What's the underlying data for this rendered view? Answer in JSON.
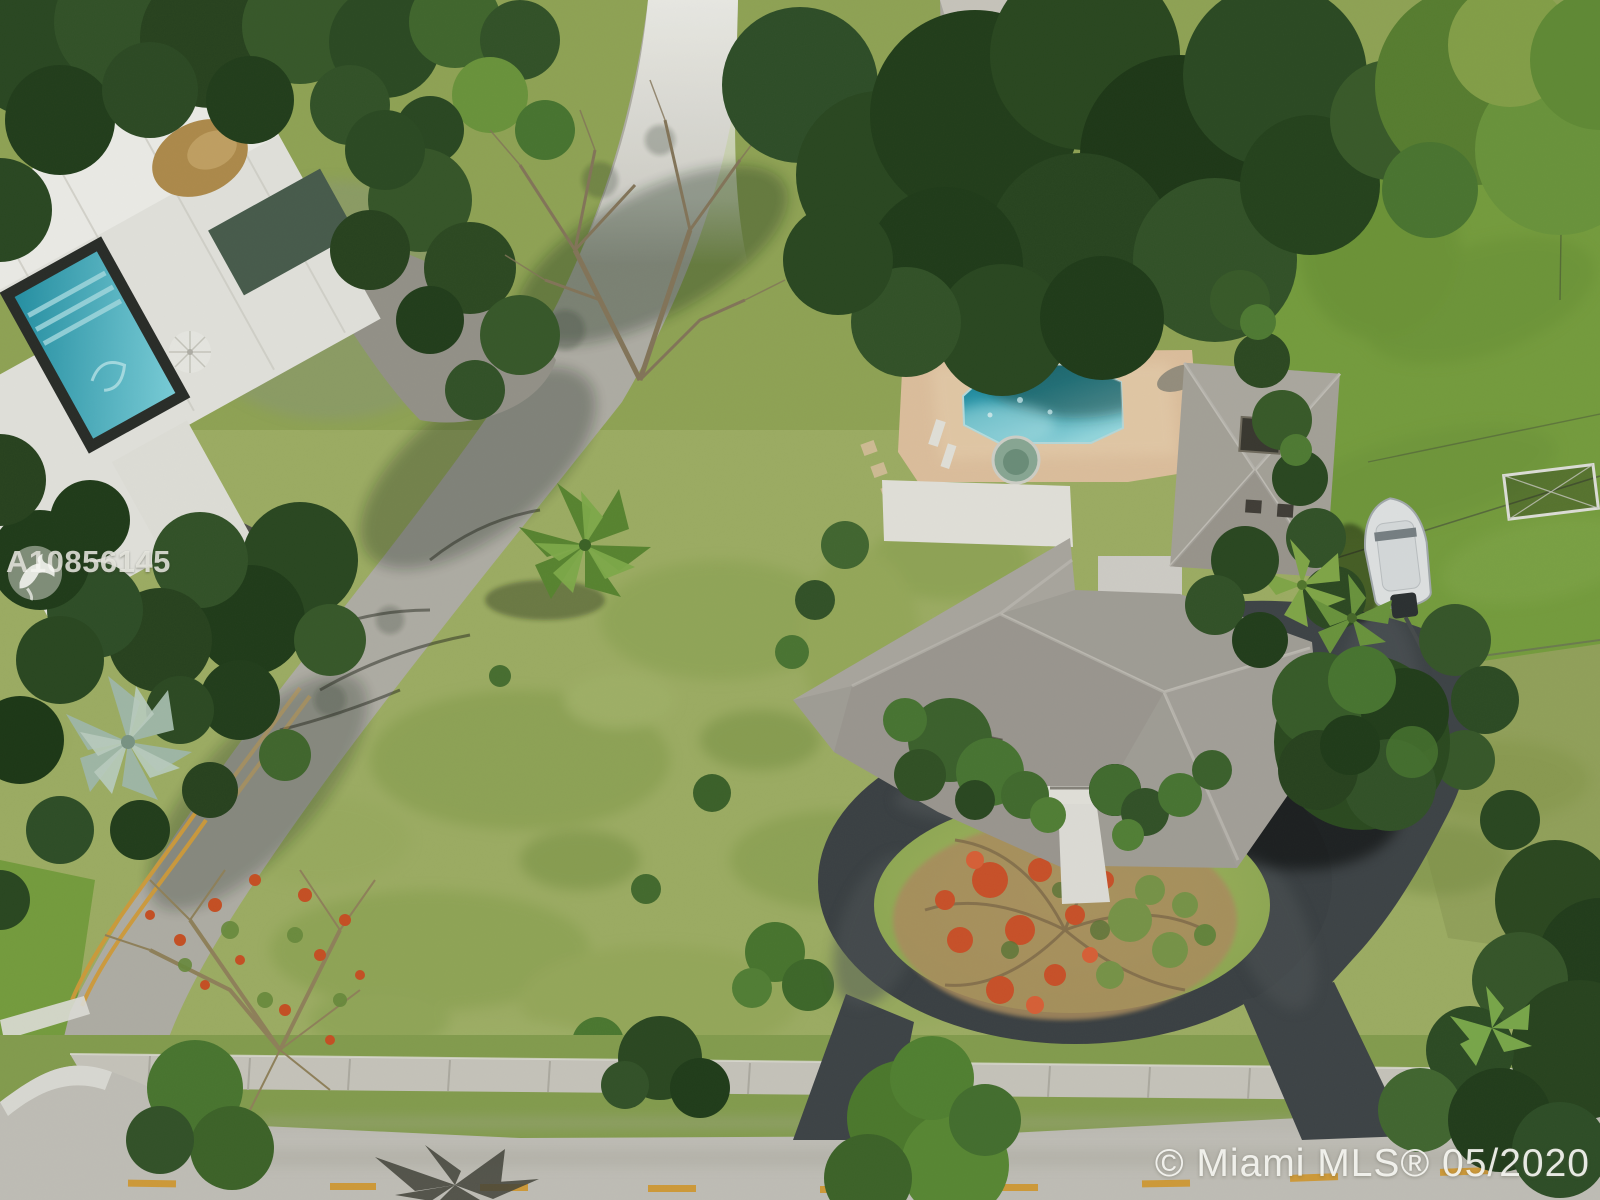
{
  "image": {
    "kind": "aerial-drone-real-estate-photo",
    "width": 1600,
    "height": 1200,
    "description": "Overhead aerial view of a large suburban corner lot: gray-shingle hip-roof house with hexagonal pool, tan pool deck, circular black asphalt driveway around a grass island with a flowering poinciana tree, white boat parked beside the house, wide mottled green lawn, a diagonal street with double yellow line meeting a horizontal street with dashed yellow line, neighboring flat-white-roof house with screened blue pool at upper left, dense tropical tree canopy."
  },
  "watermarks": {
    "listing_id": "A10856145",
    "logo": "bird-logo",
    "copyright": "© Miami MLS® 05/2020"
  },
  "palette": {
    "lawn": "#a4b468",
    "lawn_right": "#7ba341",
    "swale": "#8aa352",
    "road": "#c9c6bf",
    "road_bright": "#f3f2ec",
    "asphalt": "#3e4347",
    "deck": "#e7c7a4",
    "pool": "#2fa3b8",
    "pool_light": "#8fd8e0",
    "spa": "#8fae9b",
    "roof_gray": "#a8a49d",
    "roof_white": "#eceae4",
    "tree_dark": "#2c4a23",
    "tree_mid": "#44682f",
    "tree_light": "#6f9a40",
    "poinciana_orange": "#d2542b",
    "poinciana_dry": "#b39364",
    "neighbor_pool": "#35b4c6",
    "neighbor_teal_roof": "#4b5f50",
    "yellow_line": "#d9a13c",
    "boat_white": "#e9ebec"
  },
  "scene": {
    "features": [
      "diagonal-street",
      "horizontal-street",
      "double-yellow-centerline",
      "dashed-yellow-centerline",
      "stop-bar",
      "sidewalk",
      "swale-grass",
      "corner-lot-lawn",
      "main-house-hip-roof",
      "garage-wing-roof",
      "flat-white-roof-section",
      "skylight",
      "roof-vents",
      "front-walkway",
      "hexagonal-pool",
      "spa",
      "tan-pool-deck",
      "stepping-stones",
      "circular-driveway",
      "grass-island",
      "poinciana-tree",
      "magnolia-tree",
      "parked-boat",
      "boat-trailer",
      "right-side-lawn",
      "soccer-goal",
      "utility-wires",
      "hedge-line",
      "sabal-palms",
      "bismarck-palm",
      "coconut-palm",
      "neighbor-flat-roof-house",
      "neighbor-screened-pool",
      "patio-umbrella",
      "gravel-driveway",
      "bare-branch-trees",
      "tree-canopy",
      "tree-shadows",
      "palm-frond-shadow"
    ]
  }
}
